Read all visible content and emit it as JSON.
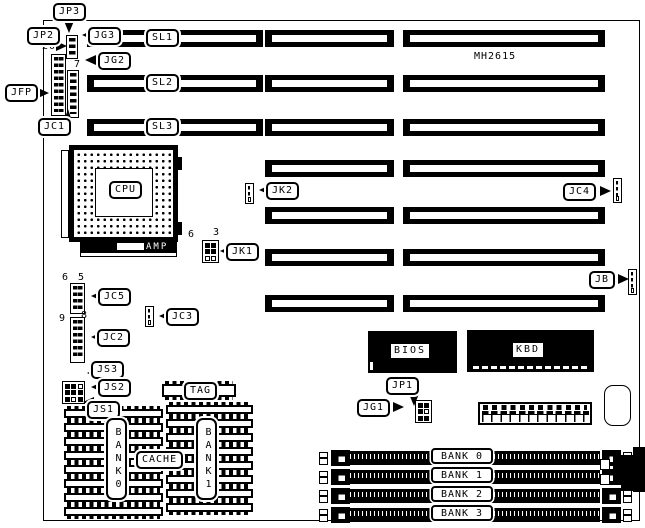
{
  "board": {
    "model": "MH2615"
  },
  "slots": {
    "sl1": "SL1",
    "sl2": "SL2",
    "sl3": "SL3"
  },
  "cpu": {
    "label": "CPU",
    "socket_brand": "AMP"
  },
  "top_connectors": {
    "jp3": "JP3",
    "jp2": "JP2",
    "jg3": "JG3",
    "jg2": "JG2",
    "jfp": "JFP",
    "jc1": "JC1",
    "jfp_pin_number": "20",
    "jc1_pin_number": "7"
  },
  "mid_connectors": {
    "jk2": "JK2",
    "jc4": "JC4",
    "jk1": "JK1",
    "jb": "JB",
    "jk1_pin_left": "6",
    "jk1_pin_right": "3"
  },
  "left_connectors": {
    "jc5": "JC5",
    "jc5_pin_left": "6",
    "jc5_pin_right": "5",
    "jc2": "JC2",
    "jc2_pin_left": "9",
    "jc2_pin_right": "8",
    "jc3": "JC3",
    "js3": "JS3",
    "js2": "JS2",
    "js1": "JS1"
  },
  "chips": {
    "bios": "BIOS",
    "kbd": "KBD",
    "tag": "TAG",
    "cache": "CACHE",
    "cache_bank_left": "BANK0",
    "cache_bank_right": "BANK1"
  },
  "bottom_connectors": {
    "jp1": "JP1",
    "jg1": "JG1"
  },
  "simm": {
    "banks": [
      "BANK 0",
      "BANK 1",
      "BANK 2",
      "BANK 3"
    ]
  },
  "colors": {
    "ink": "#000000",
    "paper": "#ffffff"
  }
}
